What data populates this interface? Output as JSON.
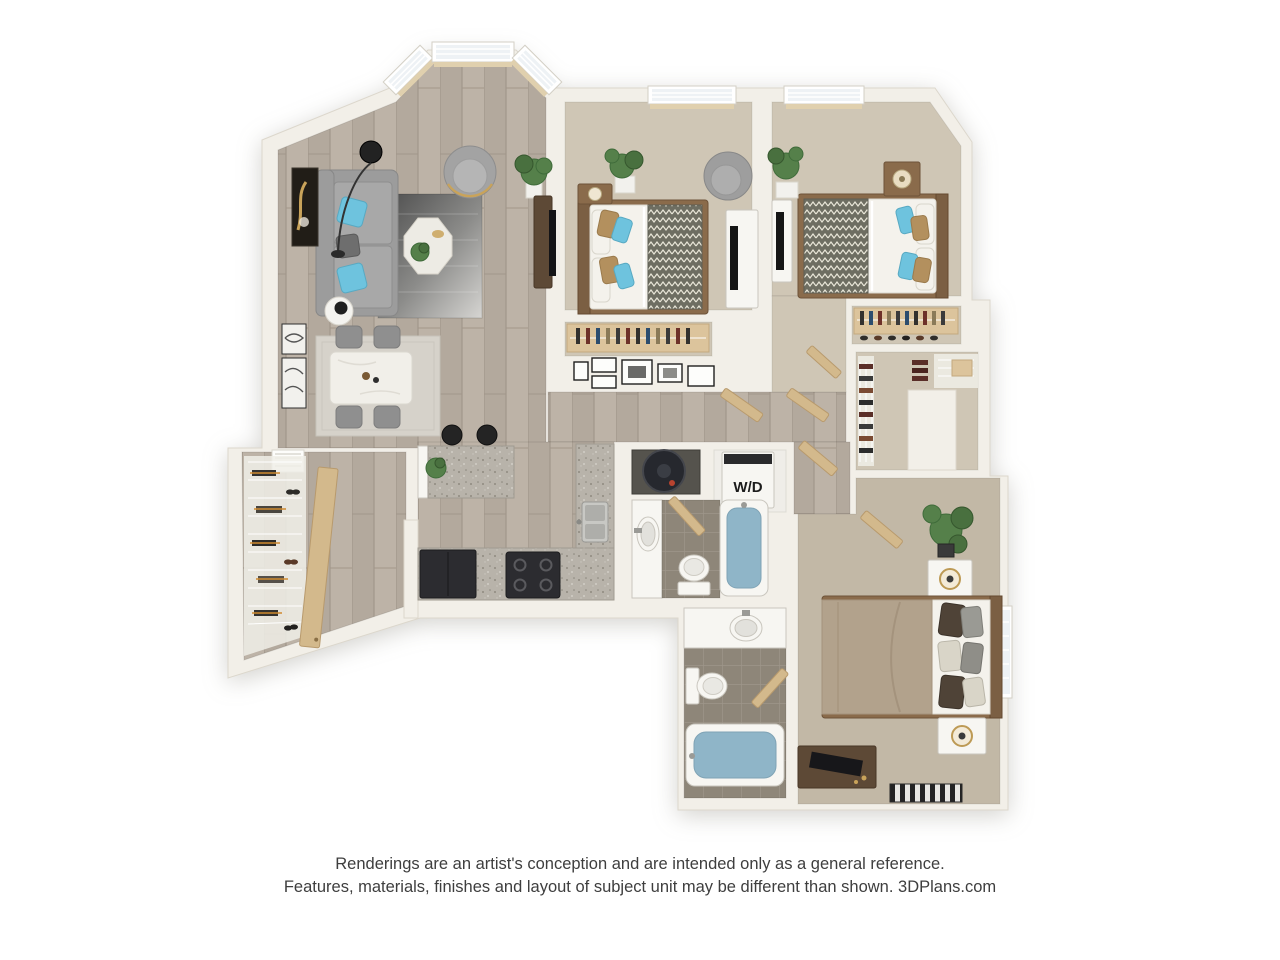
{
  "page": {
    "background": "#ffffff"
  },
  "floor_plan": {
    "labels": {
      "washer_dryer": "W/D"
    },
    "colors": {
      "wall": "#f2efe8",
      "wall_edge": "#dcd7cc",
      "wood_floor": "#b3a99d",
      "wood_plank": "#a2978a",
      "wood_plank_light": "#bdb3a7",
      "carpet": "#cfc6b5",
      "carpet_master": "#c2b8a6",
      "tile": "#8e8679",
      "tile_grout": "#9e968a",
      "tub_water": "#8fb5c8",
      "fixture_white": "#f7f6f2",
      "granite": "#b8b3aa",
      "cabinet_tan": "#dcc49c",
      "door_tan": "#d3b98c",
      "appliance_dark": "#2c2c30",
      "sofa_gray": "#9c9c9c",
      "pillow_blue": "#6ec3de",
      "pillow_tan": "#b3905e",
      "bed_white": "#f4f2ec",
      "blanket_olive": "#6e6e62",
      "headboard_brown": "#7b5f43",
      "wood_dark_furniture": "#5d4936",
      "plant_green": "#55804a",
      "rug_dark": "#4a4a4a",
      "rug_light": "#d6d5d2",
      "accent_gold": "#c9a35a",
      "window_glass": "#eef2f5",
      "sill_tan": "#e0d0ae",
      "text_dark": "#1c1c1c",
      "disclaimer_gray": "#3e3e3e"
    }
  },
  "disclaimer": {
    "line1": "Renderings are an artist's conception and are intended only as a general reference.",
    "line2": "Features, materials, finishes and layout of subject unit may be different than shown. 3DPlans.com"
  }
}
